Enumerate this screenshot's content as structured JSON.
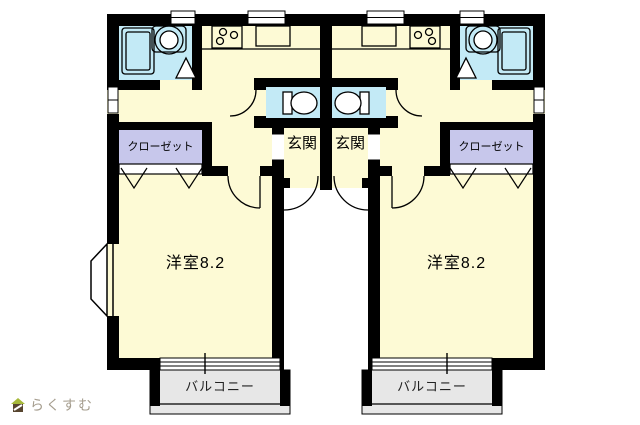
{
  "plan_type": "apartment-floor-plan",
  "units": {
    "left": {
      "room": "洋室8.2",
      "entrance": "玄関",
      "closet": "クローゼット",
      "balcony": "バルコニー"
    },
    "right": {
      "room": "洋室8.2",
      "entrance": "玄関",
      "closet": "クローゼット",
      "balcony": "バルコニー"
    }
  },
  "logo": {
    "text": "らくすむ"
  },
  "colors": {
    "room_fill": "#FDFAD5",
    "wet_area_fill": "#C3EAF6",
    "closet_fill": "#C7C7EB",
    "balcony_fill": "#E7E7E7",
    "wall": "#000000",
    "logo_text": "#A59D8E",
    "logo_roof": "#A7B93A",
    "logo_body": "#57452F"
  }
}
